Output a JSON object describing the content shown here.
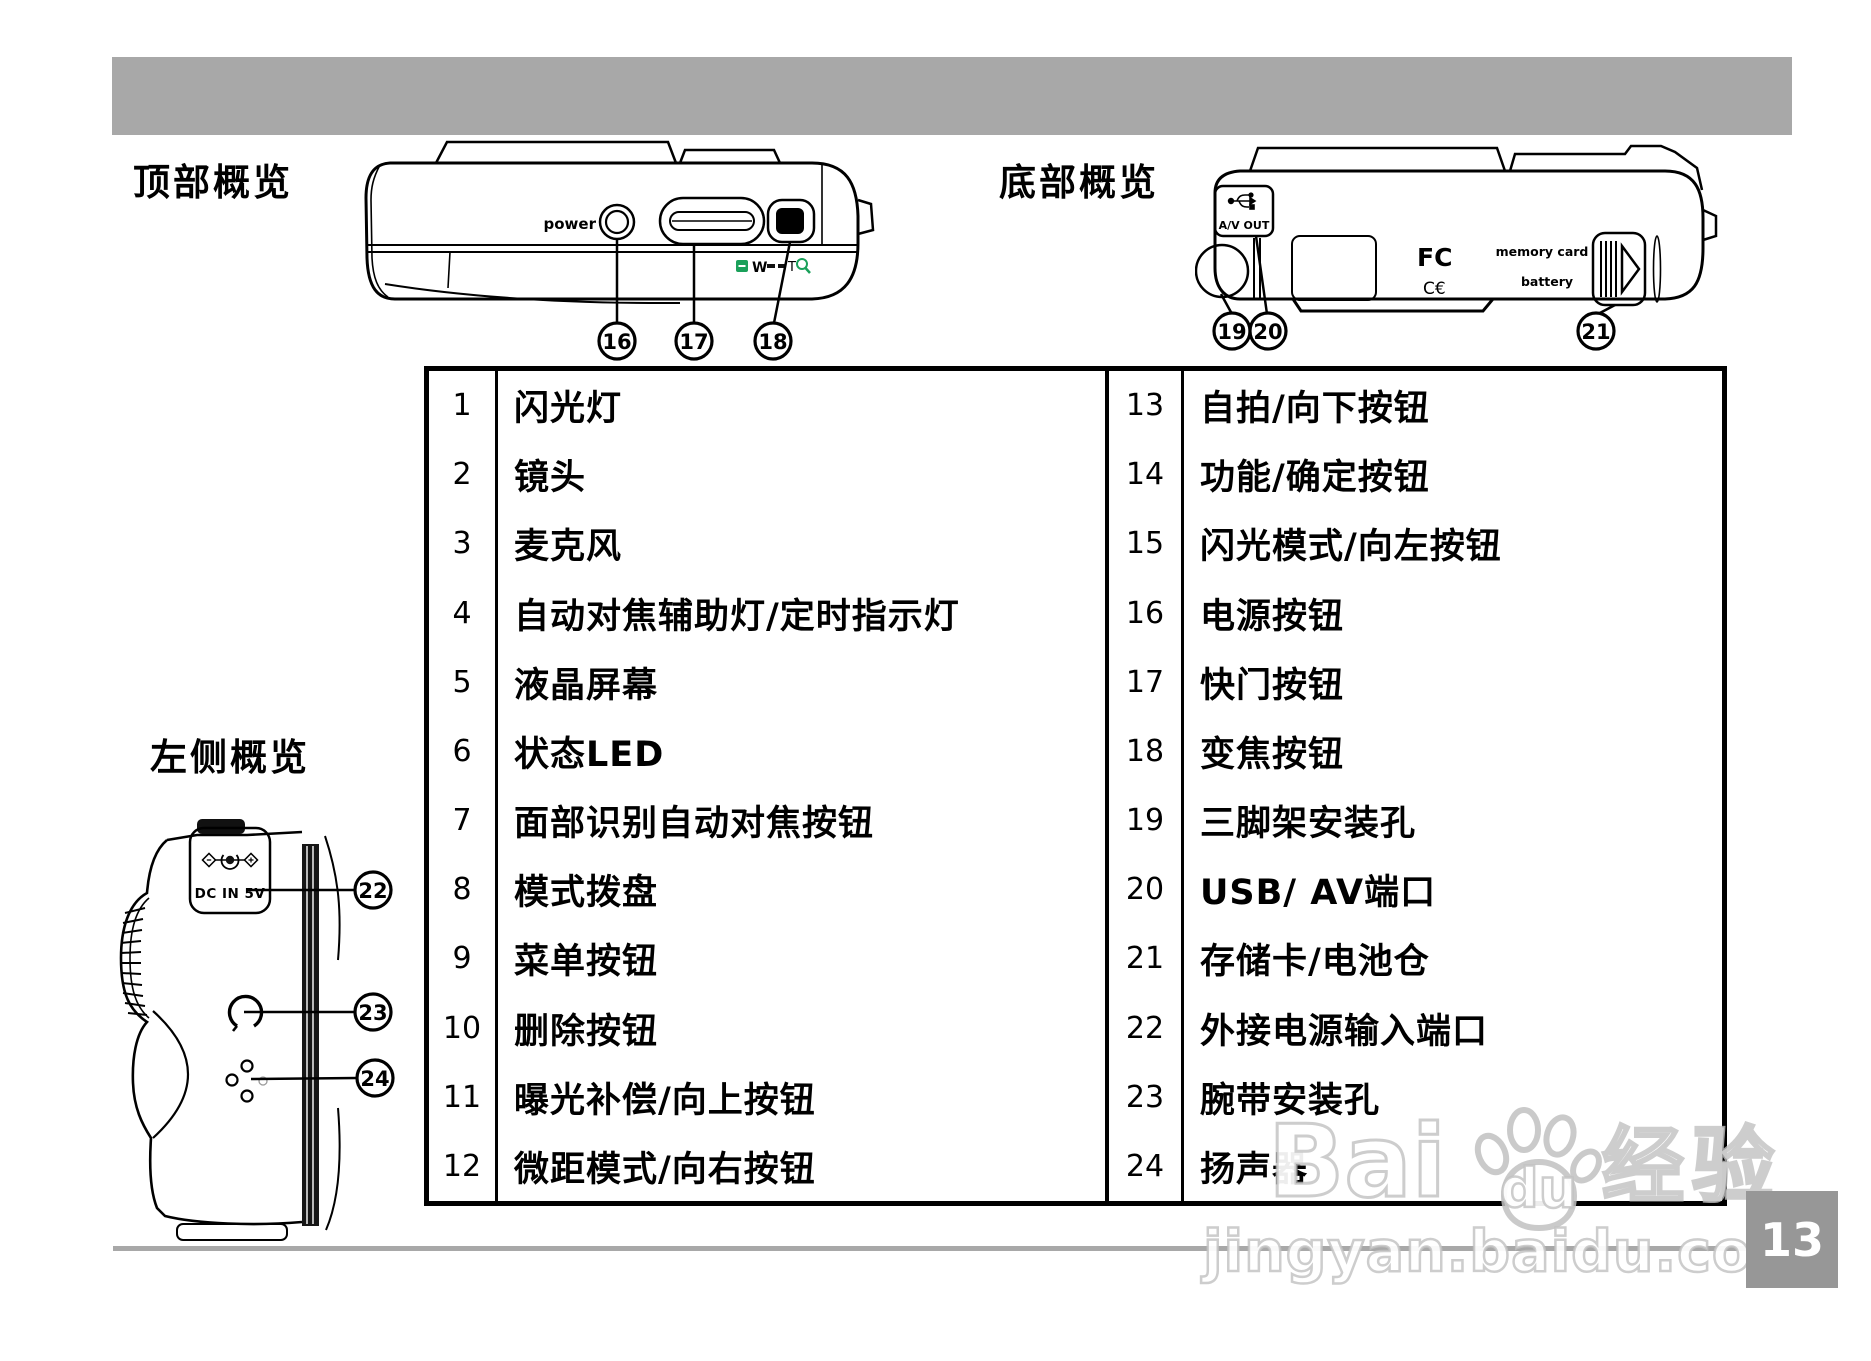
{
  "page": {
    "number": "13",
    "colors": {
      "banner_gray": "#a8a8a8",
      "rule_gray": "#a8a8a8",
      "page_box_gray": "#979797",
      "accent_green": "#1aa05a"
    }
  },
  "sections": {
    "top": {
      "title": "顶部概览",
      "power_label": "power",
      "zoom_w": "W",
      "zoom_t": "T",
      "callouts": [
        "16",
        "17",
        "18"
      ]
    },
    "bottom": {
      "title": "底部概览",
      "avout_label": "A/V OUT",
      "fcc_label": "FC",
      "ce_label": "C€",
      "memory_label": "memory card",
      "battery_label": "battery",
      "callouts": [
        "19",
        "20",
        "21"
      ]
    },
    "left": {
      "title": "左侧概览",
      "dc_label": "DC IN 5V",
      "callouts": [
        "22",
        "23",
        "24"
      ]
    }
  },
  "table": {
    "rows": [
      {
        "num": "1",
        "label": "闪光灯"
      },
      {
        "num": "2",
        "label": "镜头"
      },
      {
        "num": "3",
        "label": "麦克风"
      },
      {
        "num": "4",
        "label": "自动对焦辅助灯/定时指示灯"
      },
      {
        "num": "5",
        "label": "液晶屏幕"
      },
      {
        "num": "6",
        "label": "状态LED"
      },
      {
        "num": "7",
        "label": "面部识别自动对焦按钮"
      },
      {
        "num": "8",
        "label": "模式拨盘"
      },
      {
        "num": "9",
        "label": "菜单按钮"
      },
      {
        "num": "10",
        "label": "删除按钮"
      },
      {
        "num": "11",
        "label": "曝光补偿/向上按钮"
      },
      {
        "num": "12",
        "label": "微距模式/向右按钮"
      },
      {
        "num": "13",
        "label": "自拍/向下按钮"
      },
      {
        "num": "14",
        "label": "功能/确定按钮"
      },
      {
        "num": "15",
        "label": "闪光模式/向左按钮"
      },
      {
        "num": "16",
        "label": "电源按钮"
      },
      {
        "num": "17",
        "label": "快门按钮"
      },
      {
        "num": "18",
        "label": "变焦按钮"
      },
      {
        "num": "19",
        "label": "三脚架安装孔"
      },
      {
        "num": "20",
        "label": "USB/ AV端口"
      },
      {
        "num": "21",
        "label": "存储卡/电池仓"
      },
      {
        "num": "22",
        "label": "外接电源输入端口"
      },
      {
        "num": "23",
        "label": "腕带安装孔"
      },
      {
        "num": "24",
        "label": "扬声器"
      }
    ]
  },
  "watermark": {
    "brand_bai": "Bai",
    "brand_du": "du",
    "brand_exp": "经验",
    "url": "jingyan.baidu.com"
  }
}
